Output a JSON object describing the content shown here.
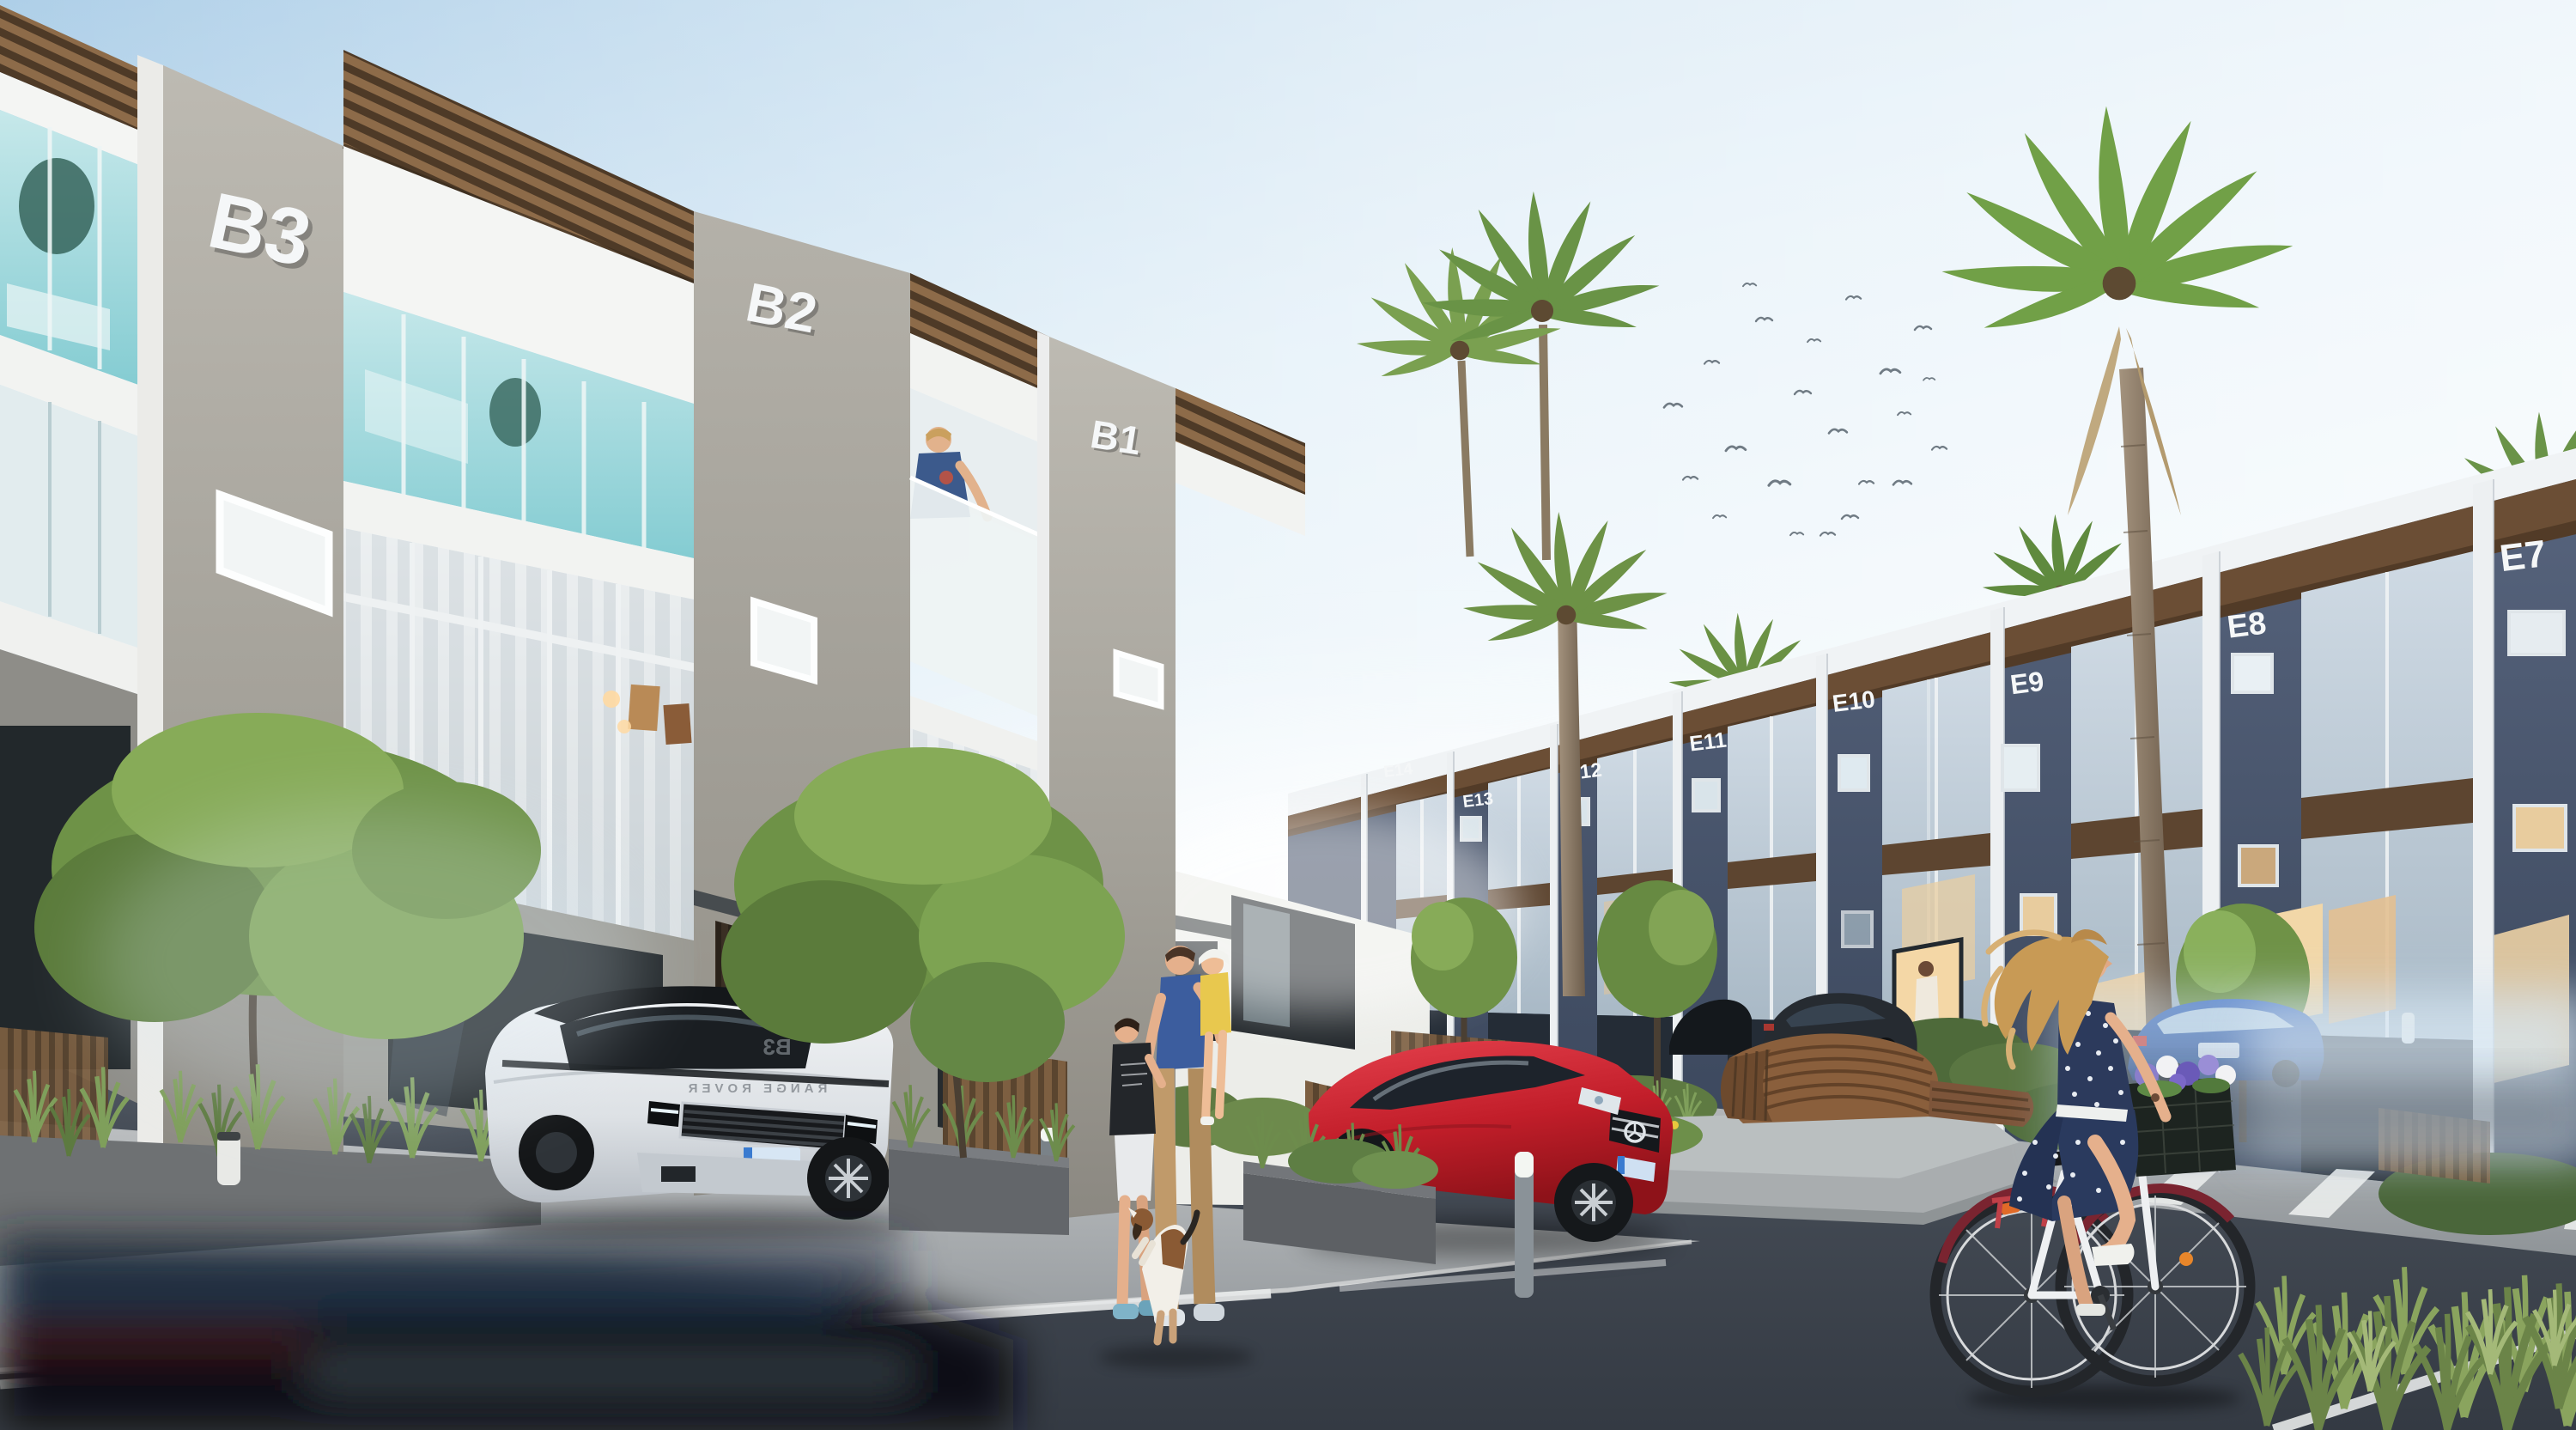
{
  "buildings": {
    "left_row": {
      "units": [
        {
          "label": "B3"
        },
        {
          "label": "B2"
        },
        {
          "label": "B1"
        }
      ]
    },
    "right_row": {
      "units": [
        {
          "label": "E14"
        },
        {
          "label": "E13"
        },
        {
          "label": "E12"
        },
        {
          "label": "E11"
        },
        {
          "label": "E10"
        },
        {
          "label": "E9"
        },
        {
          "label": "E8"
        },
        {
          "label": "E7"
        }
      ]
    }
  },
  "vehicles": {
    "range_rover": {
      "hood_text": "RANGE ROVER",
      "windshield_reflection": "B3"
    }
  },
  "palette": {
    "sky_top": "#aecfe8",
    "sky_horizon": "#f4fafc",
    "concrete": "#b3b0a8",
    "white_wall": "#f6f7f7",
    "pergola_wood": "#8d6b49",
    "aqua_glass": "#9fd8dc",
    "right_facade": "#4e5a70",
    "wood_band": "#6b4e35",
    "asphalt": "#3f4650",
    "sidewalk": "#aaaeb1",
    "red_car": "#c8232e",
    "rover_white": "#e9ebee",
    "blue_car": "#2f62b5",
    "tree_green": "#6f9247",
    "palm_green": "#71a047",
    "warm_window": "#ecd0a4",
    "navy_dress": "#2a3a5e",
    "hair_blonde": "#c89a55"
  }
}
